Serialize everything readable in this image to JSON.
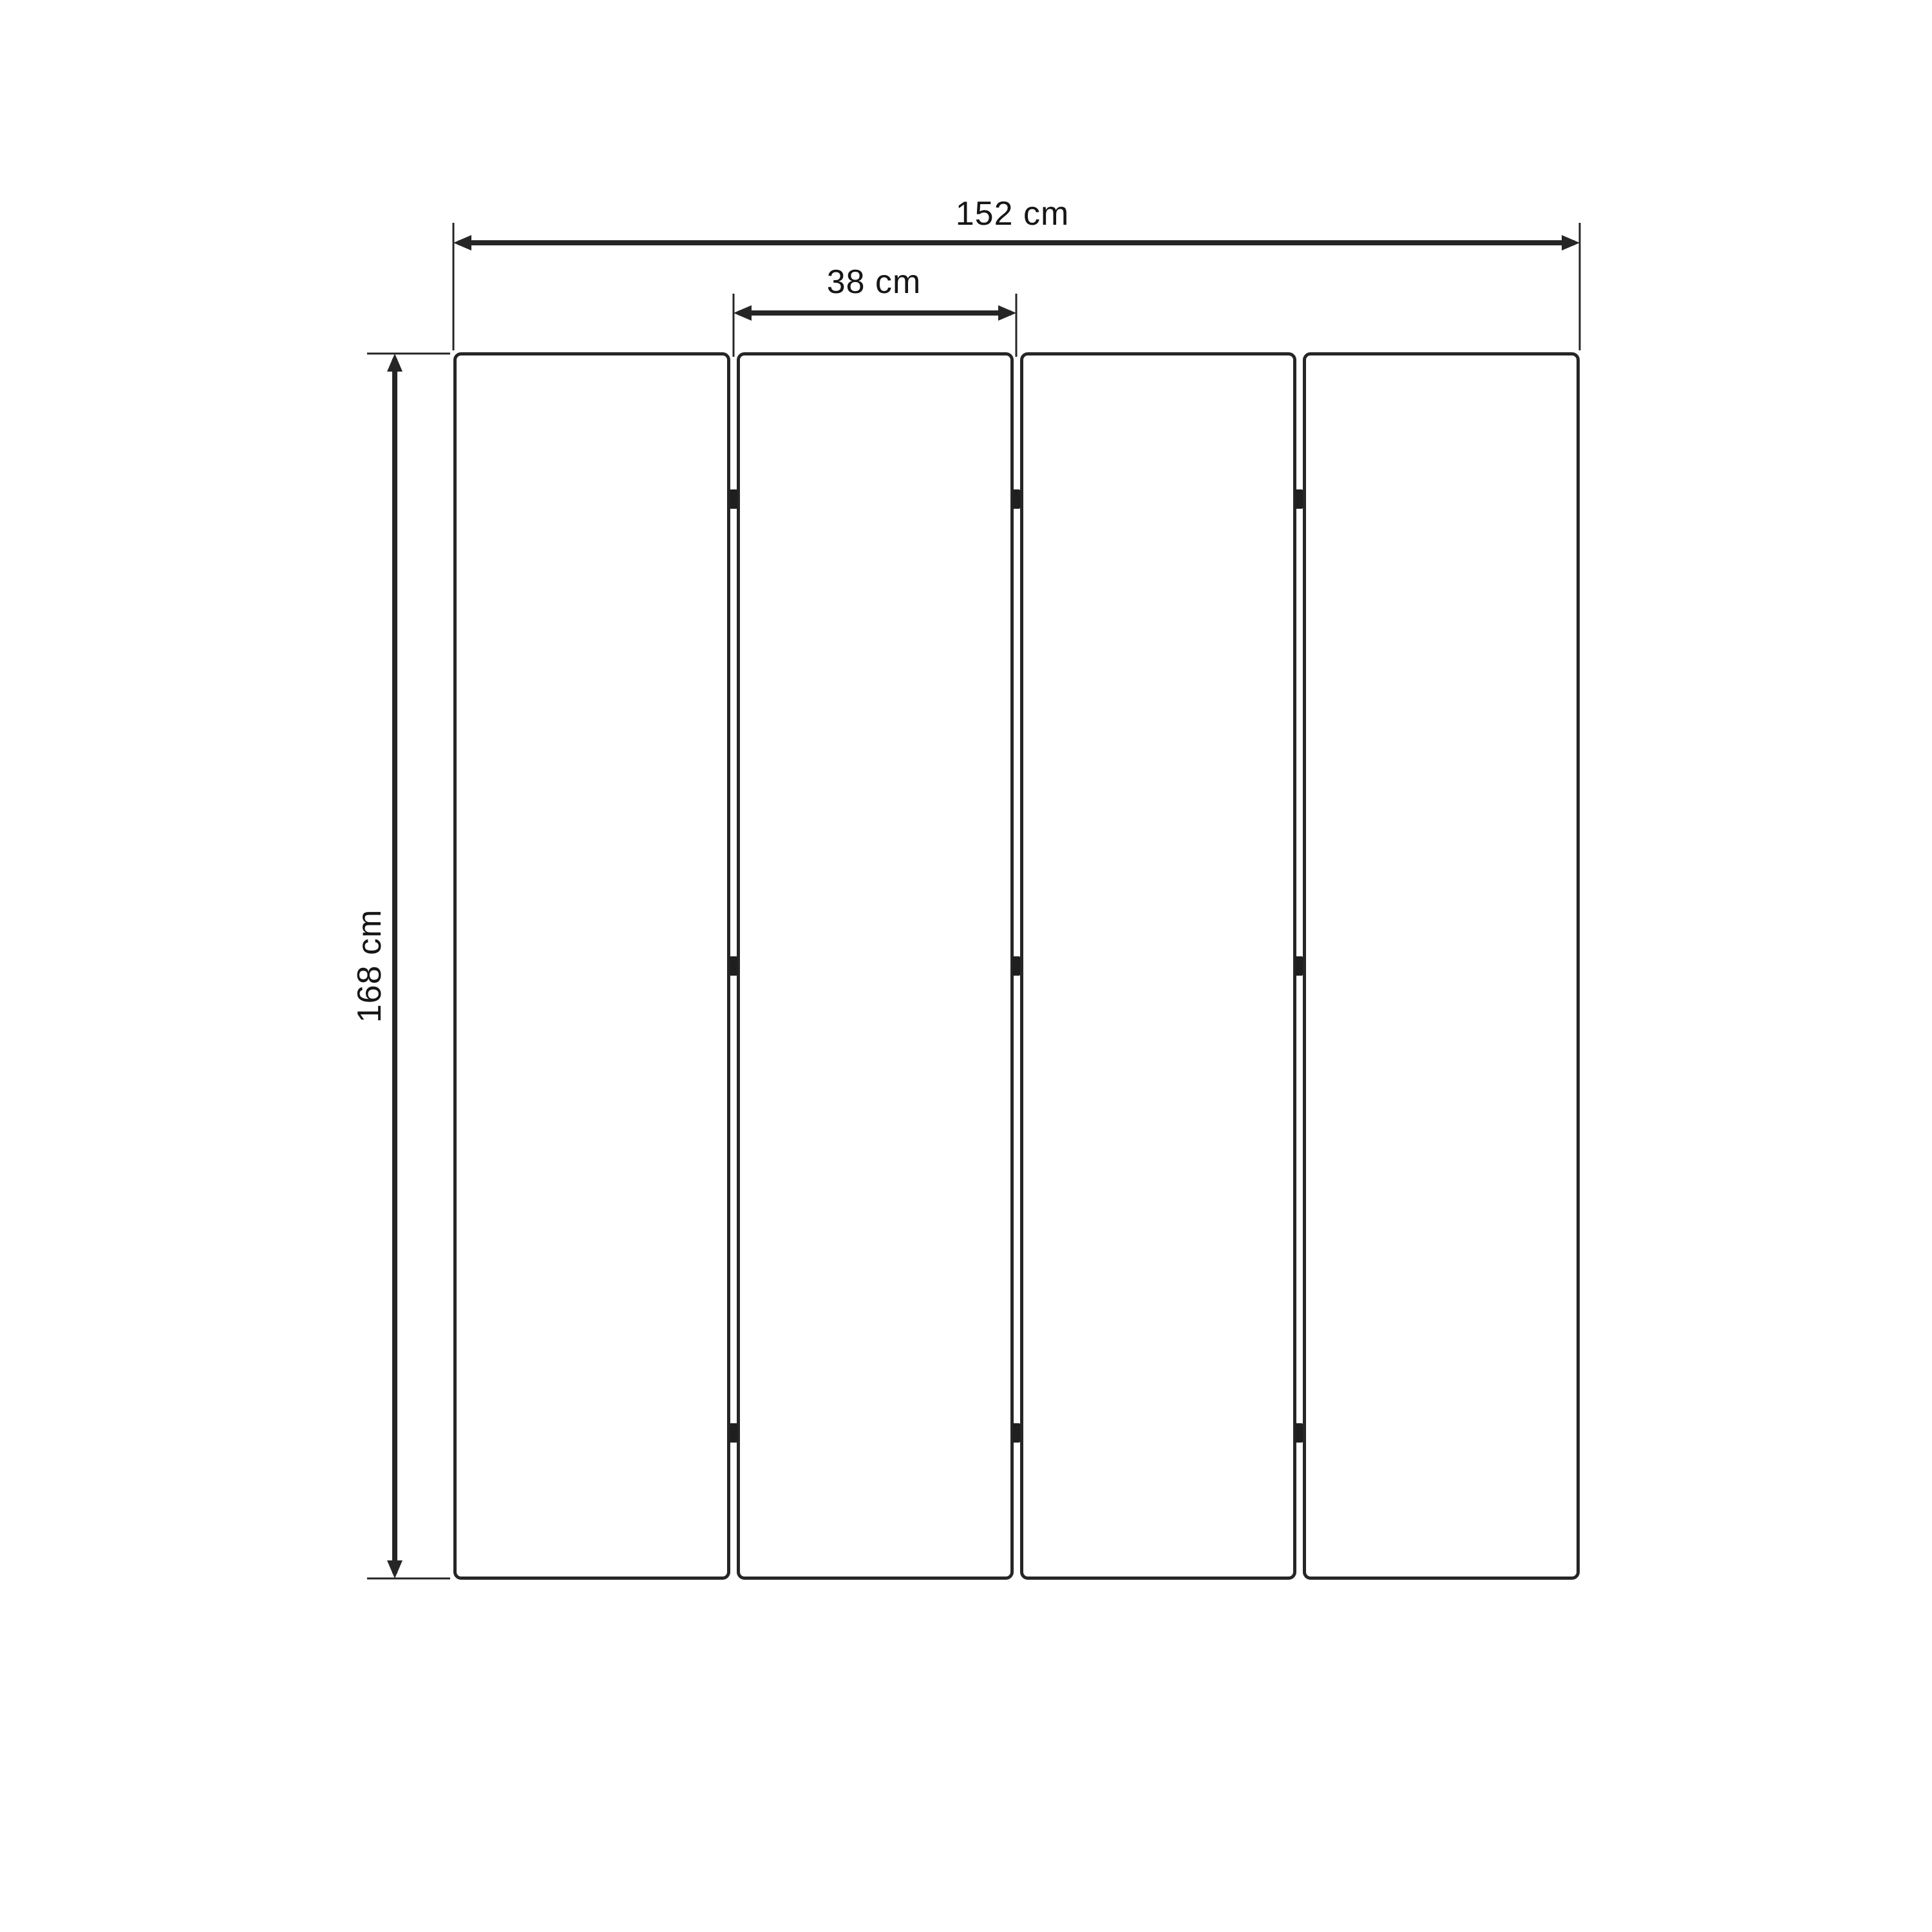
{
  "diagram": {
    "type": "product-dimension-diagram",
    "panel_count": 4,
    "labels": {
      "total_width": "152 cm",
      "panel_width": "38 cm",
      "height": "168 cm"
    },
    "colors": {
      "line": "#262626",
      "hinge": "#1f1f1f",
      "text": "#161616",
      "panel_fill": "#ffffff",
      "background": "#ffffff"
    }
  }
}
